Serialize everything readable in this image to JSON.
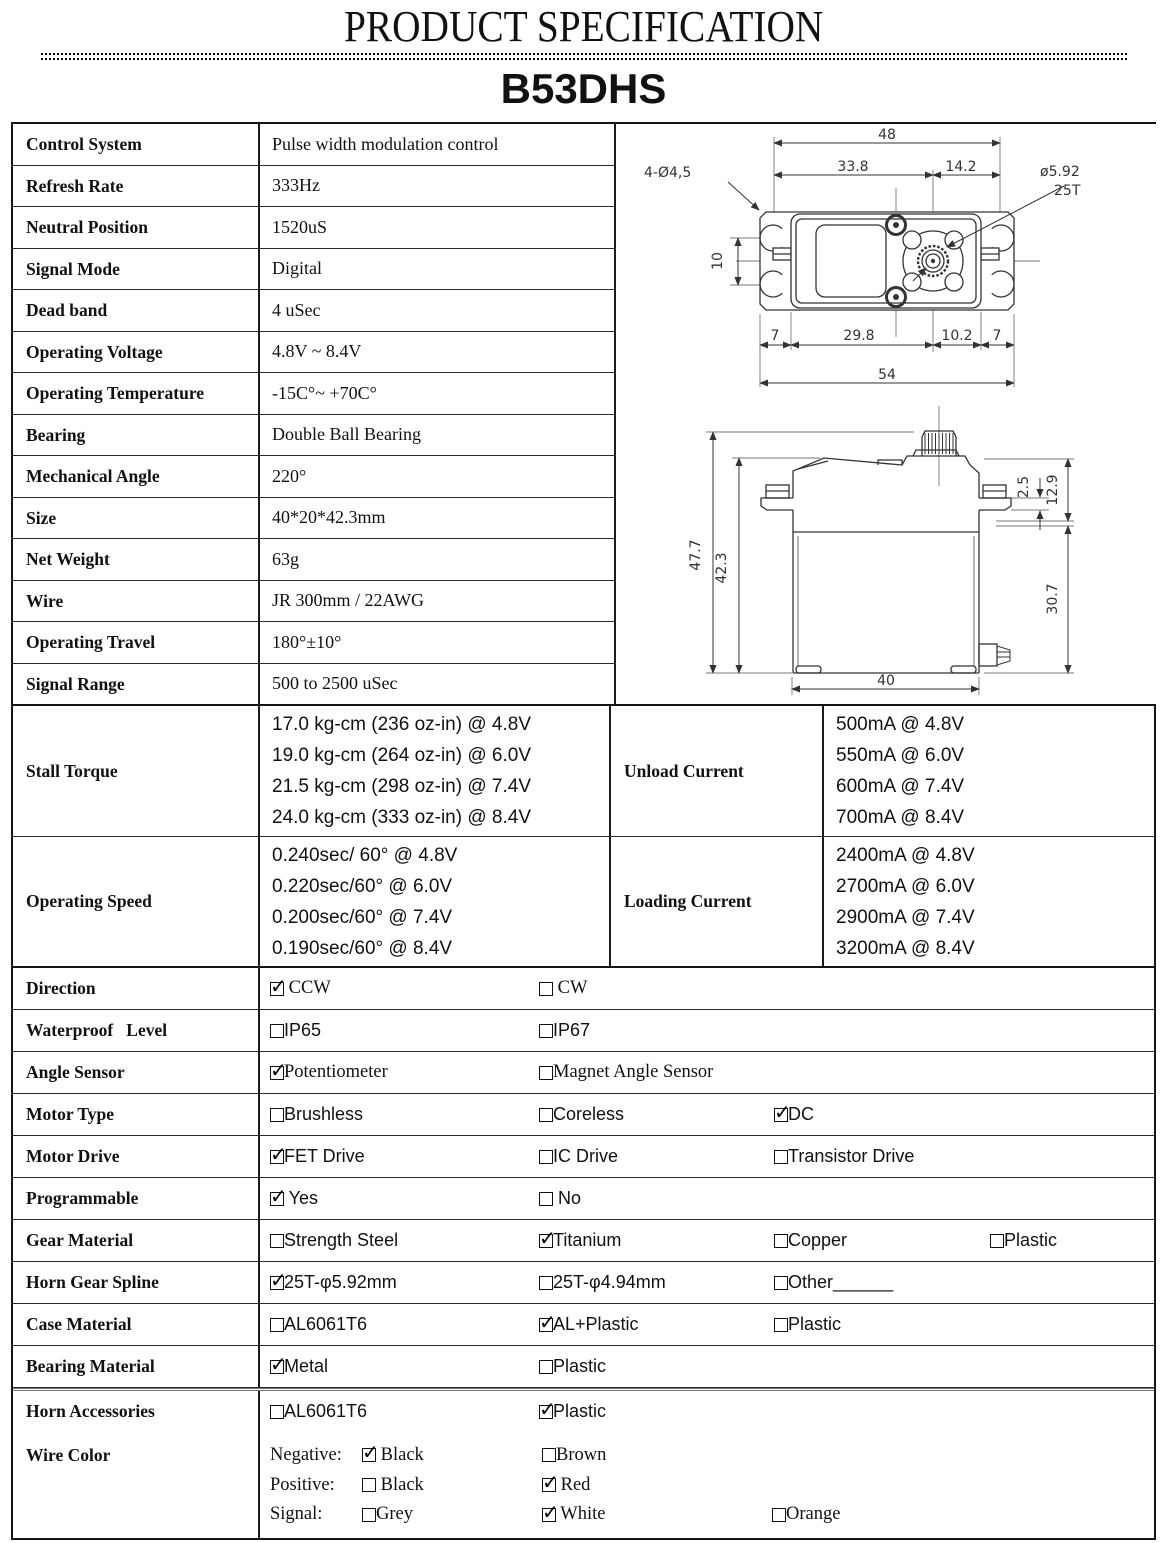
{
  "header": {
    "title": "PRODUCT SPECIFICATION",
    "model": "B53DHS"
  },
  "specs": [
    {
      "label": "Control System",
      "value": "Pulse width modulation control"
    },
    {
      "label": "Refresh Rate",
      "value": "333Hz"
    },
    {
      "label": "Neutral Position",
      "value": "1520uS"
    },
    {
      "label": "Signal Mode",
      "value": "Digital"
    },
    {
      "label": "Dead band",
      "value": "4 uSec"
    },
    {
      "label": "Operating Voltage",
      "value": "4.8V ~ 8.4V"
    },
    {
      "label": "Operating Temperature",
      "value": "-15C°~ +70C°"
    },
    {
      "label": "Bearing",
      "value": "Double Ball Bearing"
    },
    {
      "label": "Mechanical Angle",
      "value": "220°"
    },
    {
      "label": "Size",
      "value": "40*20*42.3mm"
    },
    {
      "label": "Net Weight",
      "value": "63g"
    },
    {
      "label": "Wire",
      "value": "JR 300mm / 22AWG"
    },
    {
      "label": "Operating Travel",
      "value": "180°±10°"
    },
    {
      "label": "Signal Range",
      "value": "500 to 2500 uSec"
    }
  ],
  "perf": {
    "torque": {
      "label": "Stall Torque",
      "lines": [
        "17.0 kg-cm (236 oz-in) @ 4.8V",
        "19.0 kg-cm (264 oz-in) @ 6.0V",
        "21.5 kg-cm (298 oz-in) @ 7.4V",
        "24.0 kg-cm (333 oz-in) @ 8.4V"
      ]
    },
    "unload": {
      "label": "Unload Current",
      "lines": [
        "500mA @ 4.8V",
        "550mA @ 6.0V",
        "600mA @ 7.4V",
        "700mA @ 8.4V"
      ]
    },
    "speed": {
      "label": "Operating Speed",
      "lines": [
        "0.240sec/ 60° @ 4.8V",
        "0.220sec/60° @ 6.0V",
        "0.200sec/60° @ 7.4V",
        "0.190sec/60° @ 8.4V"
      ]
    },
    "loading": {
      "label": "Loading Current",
      "lines": [
        "2400mA @ 4.8V",
        "2700mA @ 6.0V",
        "2900mA @ 7.4V",
        "3200mA @ 8.4V"
      ]
    }
  },
  "options": [
    {
      "label": "Direction",
      "font": "serif",
      "items": [
        {
          "t": " CCW",
          "c": true
        },
        {
          "t": " CW",
          "c": false
        }
      ]
    },
    {
      "label": "Waterproof   Level",
      "font": "sans",
      "items": [
        {
          "t": "IP65",
          "c": false
        },
        {
          "t": "IP67",
          "c": false
        }
      ]
    },
    {
      "label": "Angle Sensor",
      "font": "serif",
      "items": [
        {
          "t": "Potentiometer",
          "c": true
        },
        {
          "t": "Magnet Angle Sensor",
          "c": false
        }
      ]
    },
    {
      "label": "Motor Type",
      "font": "sans",
      "items": [
        {
          "t": "Brushless",
          "c": false
        },
        {
          "t": "Coreless",
          "c": false
        },
        {
          "t": "DC",
          "c": true
        }
      ]
    },
    {
      "label": "Motor Drive",
      "font": "sans",
      "items": [
        {
          "t": "FET Drive",
          "c": true
        },
        {
          "t": "IC Drive",
          "c": false
        },
        {
          "t": "Transistor Drive",
          "c": false
        }
      ]
    },
    {
      "label": "Programmable",
      "font": "sans",
      "items": [
        {
          "t": " Yes",
          "c": true
        },
        {
          "t": " No",
          "c": false
        }
      ]
    },
    {
      "label": "Gear Material",
      "font": "sans",
      "items": [
        {
          "t": "Strength Steel",
          "c": false
        },
        {
          "t": "Titanium",
          "c": true
        },
        {
          "t": "Copper",
          "c": false
        },
        {
          "t": "Plastic",
          "c": false
        }
      ]
    },
    {
      "label": "Horn Gear Spline",
      "font": "sans",
      "items": [
        {
          "t": "25T-φ5.92mm",
          "c": true
        },
        {
          "t": "25T-φ4.94mm",
          "c": false
        },
        {
          "t": "Other______",
          "c": false
        }
      ]
    },
    {
      "label": "Case Material",
      "font": "sans",
      "items": [
        {
          "t": "AL6061T6",
          "c": false
        },
        {
          "t": "AL+Plastic",
          "c": true
        },
        {
          "t": "Plastic",
          "c": false
        }
      ]
    },
    {
      "label": "Bearing Material",
      "font": "sans",
      "items": [
        {
          "t": "Metal",
          "c": true
        },
        {
          "t": "Plastic",
          "c": false
        }
      ]
    },
    {
      "label": "Horn Accessories",
      "font": "sans",
      "items": [
        {
          "t": "AL6061T6",
          "c": false
        },
        {
          "t": "Plastic",
          "c": true
        }
      ]
    }
  ],
  "wire": {
    "label": "Wire Color",
    "rows": [
      {
        "prefix": "Negative:",
        "items": [
          {
            "t": " Black",
            "c": true
          },
          {
            "t": "Brown",
            "c": false
          }
        ]
      },
      {
        "prefix": "Positive:",
        "items": [
          {
            "t": " Black",
            "c": false
          },
          {
            "t": " Red",
            "c": true
          }
        ]
      },
      {
        "prefix": "Signal:",
        "items": [
          {
            "t": "Grey",
            "c": false
          },
          {
            "t": " White",
            "c": true
          },
          {
            "t": "Orange",
            "c": false
          }
        ]
      }
    ]
  },
  "drawing_top": {
    "d48": "48",
    "d338": "33.8",
    "d142": "14.2",
    "holes": "4-Ø4,5",
    "shaft_dia": "ø5.92",
    "shaft_teeth": "25T",
    "d10": "10",
    "d7a": "7",
    "d298": "29.8",
    "d102": "10.2",
    "d7b": "7",
    "d54": "54"
  },
  "drawing_side": {
    "d477": "47.7",
    "d423": "42.3",
    "d25": "2.5",
    "d129": "12.9",
    "d307": "30.7",
    "d40": "40"
  },
  "colors": {
    "ink": "#111111",
    "drawing_line": "#333333"
  }
}
